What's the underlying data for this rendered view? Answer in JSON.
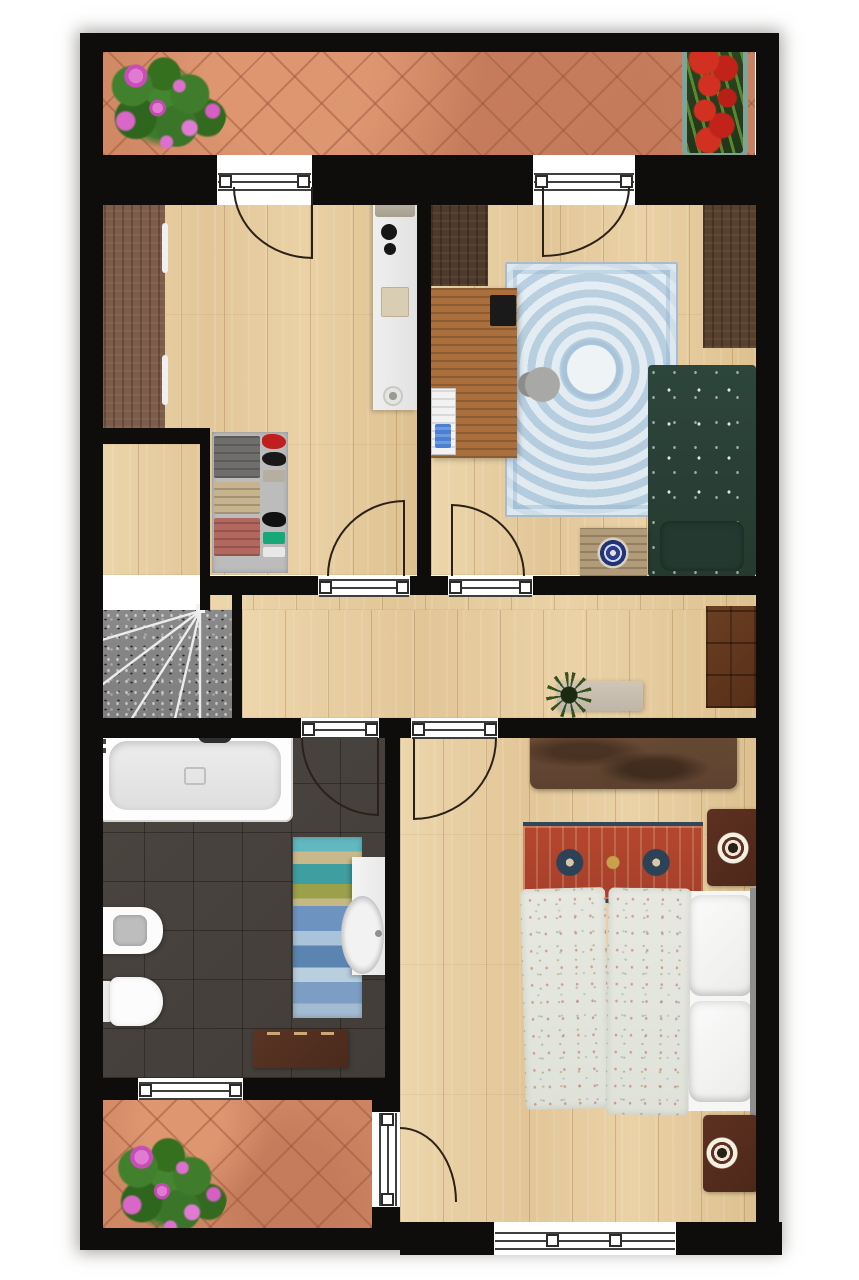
{
  "meta": {
    "kind": "architectural-floor-plan",
    "view": "top-down",
    "text_labels": []
  },
  "palette": {
    "wall": "#0e0d0b",
    "terrace_tile": "#d28a66",
    "terrace_grout": "#a5664c",
    "wood": "#e2c698",
    "bath_tile": "#4b4540",
    "terrazzo": "#8a8a8a",
    "rug_blue": "#cbdce8",
    "bed_green": "#2d463c",
    "rug_red": "#b5472e",
    "rug_red_navy": "#2c4257",
    "duvet": "#e7e9e1",
    "wardrobe_light": "#7d5c49",
    "wardrobe_dark": "#4e3a2a",
    "desk_wood": "#aa6f3d",
    "master_wardrobe": "#6b4b34",
    "nightstand": "#5e3121",
    "bath_cabinet": "#5a3424",
    "hall_cabinet": "#6b3f22",
    "bench": "#c9c0b2",
    "shelf": "#bcbcbc",
    "fixture_white": "#ffffff",
    "headboard": "#8e8e8c",
    "flower_pink": "#d760c5",
    "flower_red": "#c1231b",
    "leaf_green": "#3c7a2c",
    "planter": "#7fa398"
  },
  "rooms": [
    {
      "id": "terrace-top",
      "floor": "terracotta-tile",
      "items": [
        "pink-flower-bush",
        "red-flower-planter",
        "balcony-door-left",
        "balcony-door-right"
      ]
    },
    {
      "id": "room-top-left",
      "floor": "oak-plank",
      "items": [
        "wardrobe",
        "desk-with-printer",
        "open-shelf-with-clothes",
        "door-to-hallway"
      ]
    },
    {
      "id": "bedroom-small",
      "floor": "oak-plank",
      "items": [
        "wardrobe-top",
        "wardrobe-right",
        "wooden-desk",
        "laptop",
        "office-chair",
        "blue-ornate-rug",
        "green-single-bed",
        "pillow",
        "chest-with-mandala-plate",
        "radiator",
        "door-to-hallway"
      ]
    },
    {
      "id": "staircase",
      "floor": "terrazzo",
      "items": [
        "straight-flight",
        "winder-steps"
      ]
    },
    {
      "id": "hallway",
      "floor": "oak-plank",
      "items": [
        "bench",
        "potted-plant",
        "brown-cabinet"
      ]
    },
    {
      "id": "bathroom",
      "floor": "dark-tile",
      "items": [
        "bathtub",
        "bidet",
        "toilet",
        "vanity-sink",
        "striped-rug",
        "brown-cabinet",
        "window-to-terrace",
        "door-to-hallway"
      ]
    },
    {
      "id": "bedroom-master",
      "floor": "oak-plank",
      "items": [
        "mottled-wardrobe",
        "oriental-red-rug",
        "nightstand-upper",
        "nightstand-lower",
        "double-bed-floral-duvet",
        "white-pillows",
        "headboard",
        "window-bottom",
        "door-to-hallway",
        "door-to-terrace"
      ]
    },
    {
      "id": "terrace-bottom",
      "floor": "terracotta-tile",
      "items": [
        "pink-flower-bush",
        "door-to-bedroom",
        "window-to-bathroom"
      ]
    }
  ]
}
